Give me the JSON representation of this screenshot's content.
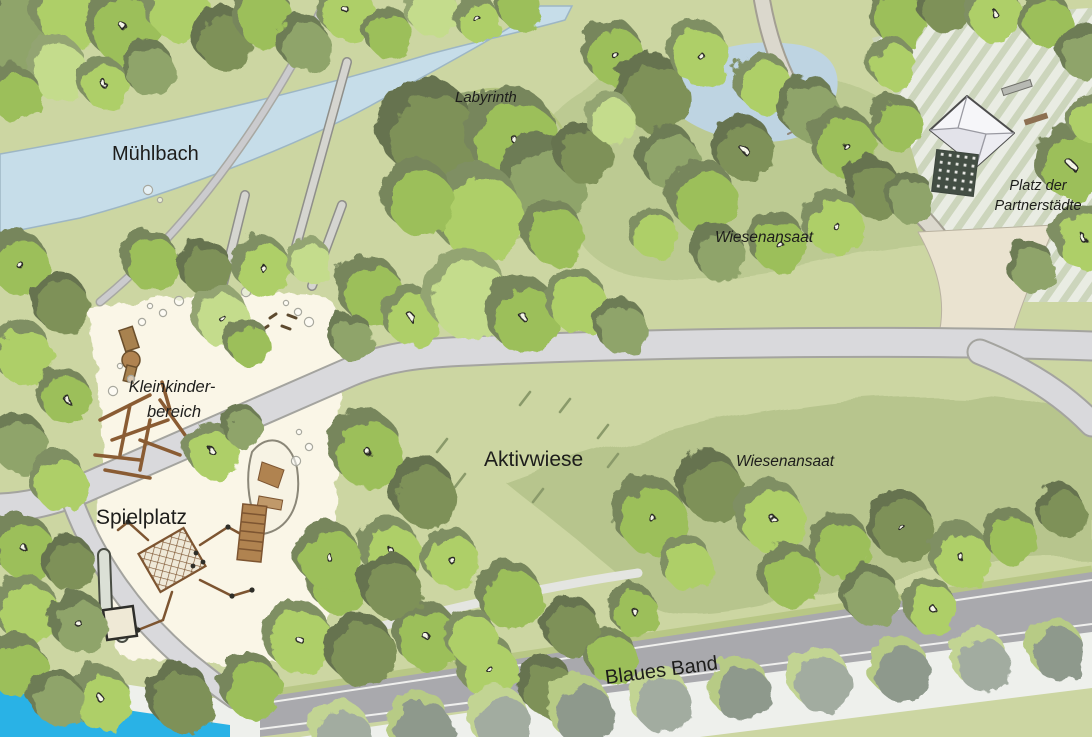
{
  "map": {
    "type": "park-site-plan",
    "labels": {
      "muehlbach": "Mühlbach",
      "labyrinth": "Labyrinth",
      "wiesenansaat_nord": "Wiesenansaat",
      "platz_line1": "Platz der",
      "platz_line2": "Partnerstädte",
      "kleinkinder_line1": "Kleinkinder-",
      "kleinkinder_line2": "bereich",
      "spielplatz": "Spielplatz",
      "aktivwiese": "Aktivwiese",
      "wiesenansaat_sued": "Wiesenansaat",
      "blaues_band": "Blaues Band"
    },
    "colors": {
      "lawn": "#ccd6a2",
      "meadow": "#bcca92",
      "meadow_dark": "#b7c58d",
      "water_stream": "#c6dde9",
      "water_blue": "#29b2e6",
      "path": "#d9d9dc",
      "path_edge": "#a4a49f",
      "road": "#a9a9ad",
      "promenade": "#eef0ec",
      "sand": "#faf6e7",
      "plaza_stripe": "#ccd5bc",
      "plaza_base": "#e9ece3",
      "roof": "#f6f6f9",
      "wood": "#8a5c33",
      "grass_mark": "#8a9a6a",
      "pebble": "#a8a89e"
    },
    "tree_palette": [
      {
        "main": "#aecf68",
        "shadow": "#7f8f63"
      },
      {
        "main": "#9cbf5a",
        "shadow": "#77865c"
      },
      {
        "main": "#c4dc8c",
        "shadow": "#93a472"
      },
      {
        "main": "#8fa46a",
        "shadow": "#6d7b55"
      },
      {
        "main": "#7e9159",
        "shadow": "#66734f"
      },
      {
        "main": "#a2aca0",
        "shadow": "#c2d493"
      },
      {
        "main": "#8e998c",
        "shadow": "#b7cb85"
      }
    ],
    "trees": [
      [
        18,
        30,
        42,
        3,
        0
      ],
      [
        70,
        12,
        36,
        0,
        0
      ],
      [
        125,
        28,
        36,
        1,
        1
      ],
      [
        178,
        8,
        32,
        0,
        0
      ],
      [
        225,
        40,
        30,
        4,
        0
      ],
      [
        58,
        70,
        30,
        2,
        0
      ],
      [
        15,
        95,
        26,
        1,
        0
      ],
      [
        150,
        70,
        26,
        3,
        0
      ],
      [
        105,
        85,
        24,
        0,
        1
      ],
      [
        265,
        18,
        30,
        1,
        0
      ],
      [
        305,
        45,
        26,
        3,
        0
      ],
      [
        348,
        12,
        28,
        0,
        1
      ],
      [
        390,
        35,
        24,
        1,
        0
      ],
      [
        432,
        10,
        26,
        2,
        0
      ],
      [
        478,
        20,
        22,
        0,
        1
      ],
      [
        520,
        8,
        22,
        1,
        0
      ],
      [
        468,
        165,
        62,
        2,
        0
      ],
      [
        432,
        135,
        48,
        4,
        0
      ],
      [
        515,
        140,
        45,
        1,
        1
      ],
      [
        545,
        185,
        42,
        3,
        0
      ],
      [
        480,
        215,
        45,
        0,
        0
      ],
      [
        555,
        235,
        30,
        1,
        0
      ],
      [
        585,
        155,
        28,
        4,
        0
      ],
      [
        420,
        200,
        35,
        1,
        0
      ],
      [
        615,
        55,
        30,
        1,
        1
      ],
      [
        655,
        95,
        36,
        4,
        0
      ],
      [
        700,
        55,
        30,
        0,
        1
      ],
      [
        670,
        160,
        30,
        3,
        0
      ],
      [
        705,
        200,
        34,
        1,
        0
      ],
      [
        745,
        150,
        30,
        4,
        1
      ],
      [
        765,
        85,
        28,
        0,
        0
      ],
      [
        810,
        110,
        30,
        3,
        0
      ],
      [
        845,
        145,
        32,
        1,
        1
      ],
      [
        875,
        190,
        28,
        4,
        0
      ],
      [
        835,
        225,
        30,
        0,
        1
      ],
      [
        780,
        245,
        28,
        1,
        1
      ],
      [
        720,
        255,
        26,
        3,
        0
      ],
      [
        655,
        235,
        24,
        0,
        0
      ],
      [
        612,
        120,
        24,
        2,
        0
      ],
      [
        900,
        18,
        28,
        1,
        0
      ],
      [
        945,
        6,
        26,
        4,
        0
      ],
      [
        995,
        14,
        28,
        0,
        1
      ],
      [
        1048,
        22,
        26,
        1,
        0
      ],
      [
        1086,
        55,
        26,
        3,
        0
      ],
      [
        893,
        65,
        24,
        0,
        0
      ],
      [
        898,
        125,
        26,
        1,
        0
      ],
      [
        912,
        200,
        24,
        3,
        0
      ],
      [
        1072,
        165,
        34,
        1,
        1
      ],
      [
        1085,
        240,
        30,
        0,
        1
      ],
      [
        1032,
        268,
        24,
        3,
        0
      ],
      [
        1090,
        120,
        22,
        0,
        0
      ],
      [
        20,
        265,
        30,
        1,
        1
      ],
      [
        62,
        305,
        28,
        4,
        0
      ],
      [
        24,
        355,
        30,
        0,
        0
      ],
      [
        66,
        398,
        26,
        1,
        1
      ],
      [
        20,
        445,
        28,
        3,
        0
      ],
      [
        60,
        483,
        28,
        0,
        0
      ],
      [
        24,
        548,
        30,
        1,
        1
      ],
      [
        70,
        565,
        26,
        4,
        0
      ],
      [
        28,
        612,
        32,
        0,
        0
      ],
      [
        80,
        625,
        28,
        3,
        1
      ],
      [
        18,
        668,
        30,
        1,
        0
      ],
      [
        152,
        262,
        28,
        1,
        0
      ],
      [
        207,
        270,
        26,
        4,
        0
      ],
      [
        263,
        268,
        28,
        0,
        1
      ],
      [
        310,
        262,
        22,
        2,
        0
      ],
      [
        222,
        318,
        28,
        2,
        1
      ],
      [
        250,
        345,
        22,
        1,
        0
      ],
      [
        213,
        452,
        26,
        0,
        1
      ],
      [
        243,
        428,
        20,
        3,
        0
      ],
      [
        372,
        293,
        32,
        1,
        0
      ],
      [
        412,
        318,
        28,
        0,
        1
      ],
      [
        352,
        338,
        22,
        3,
        0
      ],
      [
        470,
        298,
        42,
        2,
        0
      ],
      [
        525,
        318,
        36,
        1,
        1
      ],
      [
        578,
        303,
        30,
        0,
        0
      ],
      [
        622,
        328,
        26,
        3,
        0
      ],
      [
        368,
        452,
        36,
        1,
        1
      ],
      [
        425,
        495,
        32,
        4,
        0
      ],
      [
        392,
        552,
        30,
        0,
        1
      ],
      [
        338,
        585,
        28,
        1,
        0
      ],
      [
        300,
        640,
        34,
        0,
        1
      ],
      [
        362,
        652,
        34,
        4,
        0
      ],
      [
        428,
        638,
        32,
        1,
        1
      ],
      [
        252,
        688,
        30,
        1,
        0
      ],
      [
        182,
        700,
        32,
        4,
        0
      ],
      [
        102,
        700,
        30,
        0,
        1
      ],
      [
        58,
        700,
        26,
        3,
        0
      ],
      [
        488,
        668,
        30,
        0,
        1
      ],
      [
        548,
        688,
        28,
        4,
        0
      ],
      [
        612,
        658,
        26,
        1,
        0
      ],
      [
        330,
        558,
        32,
        1,
        1
      ],
      [
        392,
        588,
        30,
        4,
        0
      ],
      [
        452,
        560,
        28,
        0,
        1
      ],
      [
        512,
        598,
        32,
        1,
        0
      ],
      [
        572,
        628,
        28,
        4,
        0
      ],
      [
        472,
        638,
        26,
        0,
        0
      ],
      [
        635,
        612,
        24,
        1,
        1
      ],
      [
        652,
        518,
        36,
        1,
        1
      ],
      [
        712,
        488,
        32,
        4,
        0
      ],
      [
        772,
        518,
        34,
        0,
        1
      ],
      [
        842,
        548,
        30,
        1,
        0
      ],
      [
        902,
        528,
        32,
        4,
        1
      ],
      [
        962,
        558,
        30,
        0,
        1
      ],
      [
        1012,
        538,
        26,
        1,
        0
      ],
      [
        872,
        598,
        28,
        3,
        0
      ],
      [
        932,
        608,
        26,
        0,
        1
      ],
      [
        792,
        578,
        30,
        1,
        0
      ],
      [
        1062,
        512,
        24,
        4,
        0
      ],
      [
        688,
        565,
        26,
        0,
        0
      ],
      [
        342,
        735,
        30,
        5,
        0
      ],
      [
        422,
        728,
        32,
        6,
        0
      ],
      [
        502,
        722,
        30,
        5,
        0
      ],
      [
        582,
        712,
        32,
        6,
        0
      ],
      [
        662,
        702,
        30,
        5,
        0
      ],
      [
        742,
        692,
        30,
        6,
        0
      ],
      [
        822,
        682,
        30,
        5,
        0
      ],
      [
        902,
        672,
        30,
        6,
        0
      ],
      [
        982,
        662,
        28,
        5,
        0
      ],
      [
        1058,
        652,
        28,
        6,
        0
      ]
    ],
    "grass_marks": [
      [
        437,
        452
      ],
      [
        520,
        405
      ],
      [
        598,
        438
      ],
      [
        612,
        522
      ],
      [
        533,
        502
      ],
      [
        455,
        487
      ],
      [
        608,
        467
      ],
      [
        560,
        412
      ]
    ],
    "pebbles": [
      [
        150,
        306
      ],
      [
        163,
        313
      ],
      [
        179,
        301
      ],
      [
        286,
        303
      ],
      [
        298,
        312
      ],
      [
        309,
        322
      ],
      [
        120,
        366
      ],
      [
        131,
        379
      ],
      [
        113,
        391
      ],
      [
        299,
        432
      ],
      [
        309,
        447
      ],
      [
        296,
        461
      ],
      [
        200,
        300
      ],
      [
        142,
        322
      ],
      [
        148,
        190
      ],
      [
        160,
        200
      ],
      [
        205,
        265
      ],
      [
        218,
        278
      ],
      [
        232,
        300
      ],
      [
        212,
        312
      ],
      [
        246,
        292
      ],
      [
        196,
        252
      ]
    ],
    "twigs": [
      [
        270,
        318
      ],
      [
        282,
        326
      ],
      [
        262,
        330
      ],
      [
        288,
        315
      ]
    ]
  }
}
